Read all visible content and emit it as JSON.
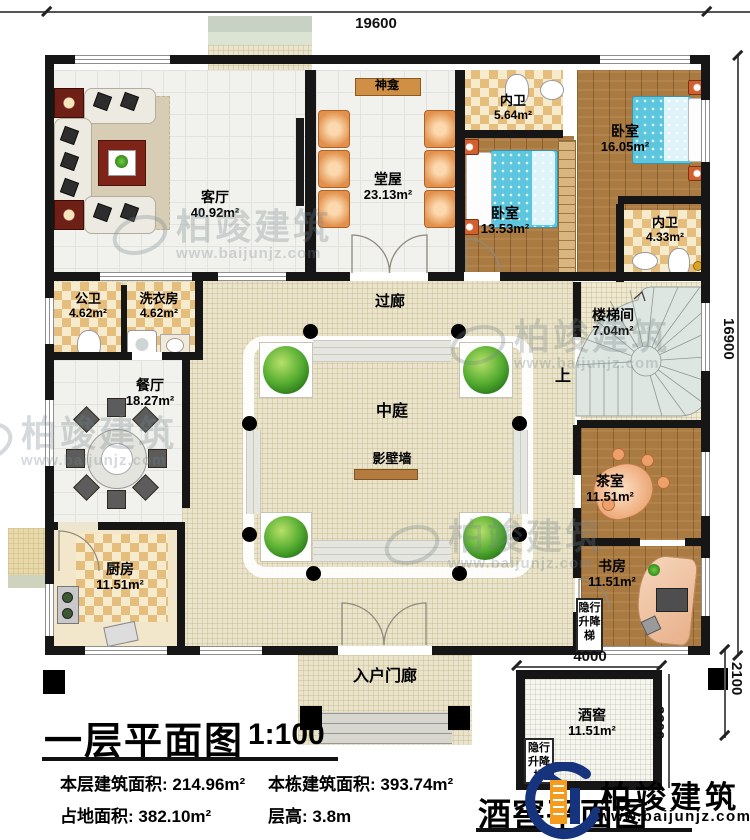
{
  "dimensions": {
    "total_width": "19600",
    "total_height": "16900",
    "cellar_width": "4000",
    "cellar_depth": "3300",
    "cellar_offset": "2100"
  },
  "rooms": {
    "living": {
      "name": "客厅",
      "area": "40.92m²"
    },
    "hall": {
      "name": "堂屋",
      "area": "23.13m²"
    },
    "shrine": {
      "name": "神龛"
    },
    "ensuite_top": {
      "name": "内卫",
      "area": "5.64m²"
    },
    "bedroom_small": {
      "name": "卧室",
      "area": "13.53m²"
    },
    "bedroom_large": {
      "name": "卧室",
      "area": "16.05m²"
    },
    "ensuite_right": {
      "name": "内卫",
      "area": "4.33m²"
    },
    "public_bath": {
      "name": "公卫",
      "area": "4.62m²"
    },
    "laundry": {
      "name": "洗衣房",
      "area": "4.62m²"
    },
    "corridor": {
      "name": "过廊"
    },
    "stairwell": {
      "name": "楼梯间",
      "area": "7.04m²"
    },
    "up_label": {
      "name": "上"
    },
    "dining": {
      "name": "餐厅",
      "area": "18.27m²"
    },
    "atrium": {
      "name": "中庭"
    },
    "screen_wall": {
      "name": "影壁墙"
    },
    "tea_room": {
      "name": "茶室",
      "area": "11.51m²"
    },
    "study": {
      "name": "书房",
      "area": "11.51m²"
    },
    "kitchen": {
      "name": "厨房",
      "area": "11.51m²"
    },
    "entry_porch": {
      "name": "入户门廊"
    },
    "wine_cellar": {
      "name": "酒窖",
      "area": "11.51m²"
    },
    "elevator": {
      "name": "隐行升降梯"
    }
  },
  "title_block": {
    "plan_title": "一层平面图",
    "scale": "1:100",
    "stats": [
      {
        "label": "本层建筑面积:",
        "value": "214.96m²"
      },
      {
        "label": "本栋建筑面积:",
        "value": "393.74m²"
      },
      {
        "label": "占地面积:",
        "value": "382.10m²"
      },
      {
        "label": "层高:",
        "value": "3.8m"
      }
    ],
    "cellar_plan_title": "酒窖平面图"
  },
  "brand": {
    "name": "柏竣建筑",
    "url": "www.baijunjz.com"
  },
  "watermark": {
    "name": "柏竣建筑",
    "url": "www.baijunjz.com"
  },
  "colors": {
    "wall": "#161616",
    "wood_floor": "#a97a42",
    "bed": "#5cc6de",
    "screen_wall": "#b57b3e",
    "logo_blue": "#16337e",
    "logo_orange": "#f59b1e"
  }
}
